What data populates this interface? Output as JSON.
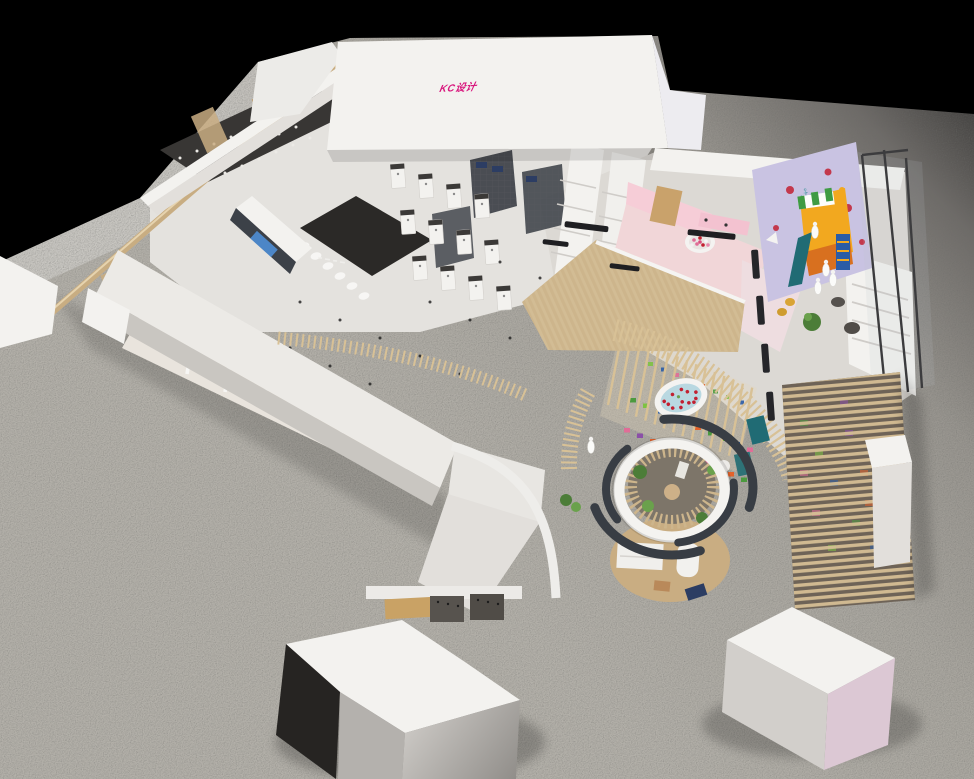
{
  "window": {
    "width": 974,
    "height": 779
  },
  "scene": {
    "kind": "isometric-3d-interior-render",
    "subject": "bathroom and mother-baby retail showroom dollhouse view",
    "logo": {
      "text": "KC设计",
      "color": "#d8177d"
    },
    "palette": {
      "bg": "#000000",
      "logoPink": "#d8177d",
      "plaza": "#a8a5a0",
      "plazaDark": "#2e2d2c",
      "storeFloor": "#e4e2de",
      "wall": "#f3f2ef",
      "wallFace": "#e2dfdb",
      "wallShadow": "#c9c6c1",
      "darkZone": "#383634",
      "blackFloor": "#2b2927",
      "wood": "#c9ad82",
      "woodSlat": "#d8c196",
      "woodDark": "#6e6357",
      "charcoal": "#383d44",
      "kidsFloor": "#f1d6d8",
      "kidsWall": "#f6cdd7",
      "mural": "#c9c3e2",
      "teal": "#206b74",
      "yellow": "#f2a81f",
      "orange": "#d8701f",
      "blue": "#2a5ca6",
      "screenBlue": "#4f93de",
      "navy": "#2c3d63",
      "water": "#b9d8e1",
      "petal": "#c22031",
      "ballPink": "#e06d97",
      "plant": "#4c7d38",
      "plantLight": "#6aa14c",
      "white": "#f7f6f4",
      "pinkFace": "#dcc8d4"
    }
  }
}
